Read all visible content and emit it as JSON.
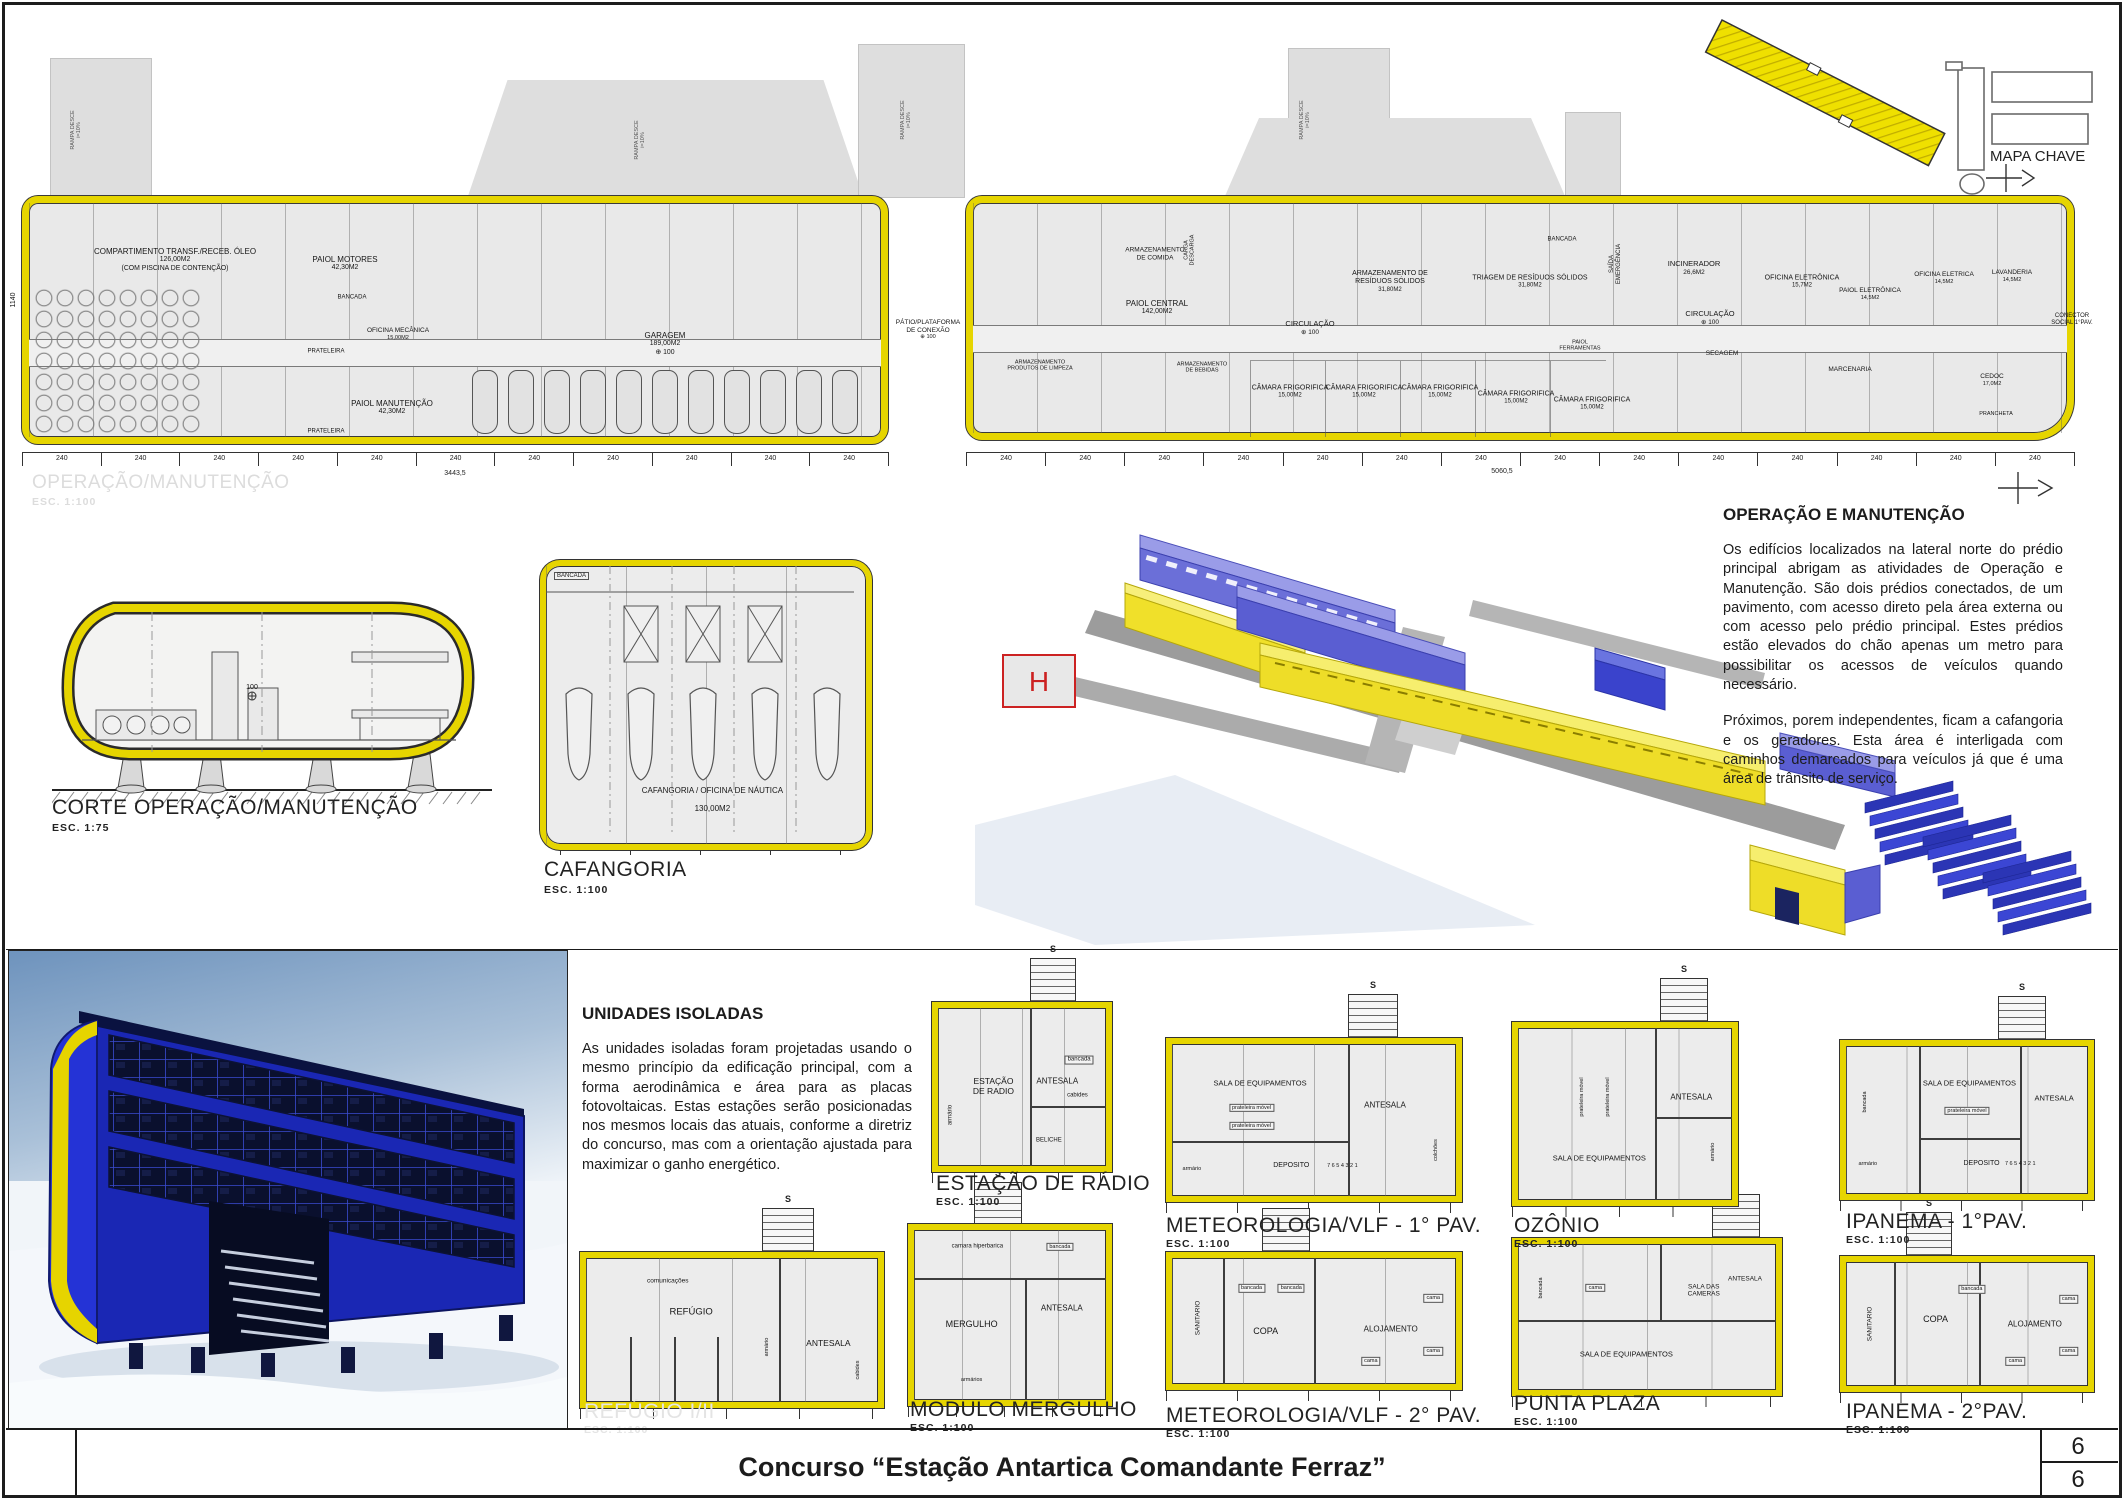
{
  "sheet": {
    "title": "Concurso “Estação Antartica Comandante Ferraz”",
    "page_number_top": "6",
    "page_number_bottom": "6"
  },
  "key_map": {
    "label": "MAPA CHAVE"
  },
  "main_plan": {
    "watermark_title": "OPERAÇÃO/MANUTENÇÃO",
    "watermark_scale": "ESC.  1:100",
    "dim_unit": "240",
    "dim_total_left": "3443,5",
    "dim_total_right": "5060,5",
    "dim_height": "1140",
    "ramp_label": "RAMPA DESCE\ni=10%",
    "ramps": [
      {
        "x": 76,
        "y": 130
      },
      {
        "x": 640,
        "y": 140
      },
      {
        "x": 906,
        "y": 120
      },
      {
        "x": 1305,
        "y": 120
      }
    ],
    "rooms": [
      {
        "label": "COMPARTIMENTO TRANSF./RECEB. ÓLEO",
        "sub": "126,00M2\n(COM PISCINA DE CONTENÇÃO)",
        "x": 175,
        "y": 260,
        "s": 8
      },
      {
        "label": "PAIOL MOTORES",
        "sub": "42,30M2",
        "x": 345,
        "y": 264,
        "s": 8
      },
      {
        "label": "BANCADA",
        "x": 352,
        "y": 298,
        "s": 6
      },
      {
        "label": "OFICINA MECÂNICA",
        "sub": "15,00M2",
        "x": 398,
        "y": 334,
        "s": 6.5
      },
      {
        "label": "PRATELEIRA",
        "x": 326,
        "y": 352,
        "s": 6
      },
      {
        "label": "PAIOL MANUTENÇÃO",
        "sub": "42,30M2",
        "x": 392,
        "y": 408,
        "s": 8
      },
      {
        "label": "PRATELEIRA",
        "x": 326,
        "y": 432,
        "s": 6
      },
      {
        "label": "GARAGEM",
        "sub": "189,00M2\n⊕ 100",
        "x": 665,
        "y": 344,
        "s": 8
      },
      {
        "label": "PÁTIO/PLATAFORMA\nDE CONEXÃO",
        "sub": "⊕ 100",
        "x": 928,
        "y": 330,
        "s": 6.5
      },
      {
        "label": "ARMAZENAMENTO\nDE COMIDA",
        "x": 1155,
        "y": 254,
        "s": 6.5
      },
      {
        "label": "CARGA\nDESCARGA",
        "x": 1190,
        "y": 250,
        "s": 5.5,
        "r": -90
      },
      {
        "label": "PAIOL CENTRAL",
        "sub": "142,00M2",
        "x": 1157,
        "y": 308,
        "s": 8
      },
      {
        "label": "ARMAZENAMENTO DE\nRESÍDUOS SÓLIDOS",
        "sub": "31,80M2",
        "x": 1390,
        "y": 282,
        "s": 7
      },
      {
        "label": "TRIAGEM DE RESÍDUOS SÓLIDOS",
        "sub": "31,80M2",
        "x": 1530,
        "y": 282,
        "s": 7
      },
      {
        "label": "BANCADA",
        "x": 1562,
        "y": 240,
        "s": 6
      },
      {
        "label": "CIRCULAÇÃO",
        "sub": "⊕ 100",
        "x": 1310,
        "y": 328,
        "s": 7.5
      },
      {
        "label": "SAÍDA\nEMERGÊNCIA",
        "x": 1616,
        "y": 264,
        "s": 6,
        "r": -90
      },
      {
        "label": "ARMAZENAMENTO\nPRODUTOS DE LIMPEZA",
        "x": 1040,
        "y": 366,
        "s": 5.5
      },
      {
        "label": "ARMAZENAMENTO\nDE BEBIDAS",
        "x": 1202,
        "y": 368,
        "s": 5.5
      },
      {
        "label": "CÂMARA FRIGORIFICA",
        "sub": "15,00M2",
        "x": 1290,
        "y": 392,
        "s": 7
      },
      {
        "label": "CÂMARA FRIGORIFICA",
        "sub": "15,00M2",
        "x": 1364,
        "y": 392,
        "s": 7
      },
      {
        "label": "CÂMARA FRIGORIFICA",
        "sub": "15,00M2",
        "x": 1440,
        "y": 392,
        "s": 7
      },
      {
        "label": "CÂMARA FRIGORIFICA",
        "sub": "15,00M2",
        "x": 1516,
        "y": 398,
        "s": 7
      },
      {
        "label": "CÂMARA FRIGORIFICA",
        "sub": "15,00M2",
        "x": 1592,
        "y": 404,
        "s": 7
      },
      {
        "label": "PAIOL\nFERRAMENTAS",
        "x": 1580,
        "y": 346,
        "s": 5.5
      },
      {
        "label": "INCINERADOR",
        "sub": "26,6M2",
        "x": 1694,
        "y": 268,
        "s": 7.5
      },
      {
        "label": "OFICINA ELETRÔNICA",
        "sub": "15,7M2",
        "x": 1802,
        "y": 282,
        "s": 7
      },
      {
        "label": "PAIOL ELETRÔNICA",
        "sub": "14,5M2",
        "x": 1870,
        "y": 294,
        "s": 6.5
      },
      {
        "label": "OFICINA ELETRICA",
        "sub": "14,5M2",
        "x": 1944,
        "y": 278,
        "s": 6.5
      },
      {
        "label": "LAVANDERIA",
        "sub": "14,5M2",
        "x": 2012,
        "y": 276,
        "s": 6.5
      },
      {
        "label": "CIRCULAÇÃO",
        "sub": "⊕ 100",
        "x": 1710,
        "y": 318,
        "s": 7.5
      },
      {
        "label": "SECAGEM",
        "x": 1722,
        "y": 354,
        "s": 6.5
      },
      {
        "label": "MARCENARIA",
        "x": 1850,
        "y": 370,
        "s": 6.5
      },
      {
        "label": "CEDOC",
        "sub": "17,0M2",
        "x": 1992,
        "y": 380,
        "s": 6.5
      },
      {
        "label": "PRANCHETA",
        "x": 1996,
        "y": 414,
        "s": 5.5
      },
      {
        "label": "CONECTOR\nSOCIAL 1°PAV.",
        "x": 2072,
        "y": 320,
        "s": 6
      }
    ]
  },
  "section": {
    "title": "CORTE OPERAÇÃO/MANUTENÇÃO",
    "scale": "ESC.  1:75",
    "level": "100"
  },
  "cafangoria": {
    "title": "CAFANGORIA",
    "scale": "ESC.  1:100",
    "room_label": "CAFANGORIA / OFICINA DE NÁUTICA",
    "room_area": "130,00M2",
    "bench_label": "BANCADA"
  },
  "iso": {
    "helipad_label": "H"
  },
  "text_blocks": {
    "operacao": {
      "title": "OPERAÇÃO E MANUTENÇÃO",
      "p1": "Os edifícios localizados na lateral norte do prédio principal abrigam as atividades de Operação e Manutenção. São dois prédios conectados, de um pavimento, com acesso direto pela área externa ou com acesso pelo prédio principal. Estes prédios estão elevados do chão apenas um metro para possibilitar os acessos de veículos quando necessário.",
      "p2": "Próximos, porem independentes, ficam a cafangoria e os geradores. Esta área é interligada com caminhos demarcados para veículos já que é uma área de trânsito de serviço."
    },
    "unidades": {
      "title": "UNIDADES ISOLADAS",
      "p1": "As unidades isoladas foram projetadas usando o mesmo princípio da edificação principal, com a forma aerodinâmica e área para as placas fotovoltaicas. Estas estações serão posicionadas nos mesmos locais das atuais, conforme a diretriz do concurso, mas com a orientação ajustada para maximizar o ganho energético."
    }
  },
  "unit_plans": [
    {
      "id": "estacao-radio",
      "title": "ESTAÇÃO DE RÁDIO",
      "scale": "ESC.  1:100",
      "frame": {
        "x": 932,
        "y": 1002,
        "w": 168,
        "h": 158
      },
      "stair": {
        "x": 1030,
        "y": 958,
        "w": 44,
        "h": 46
      },
      "stair_label": "S",
      "title_pos": {
        "x": 936,
        "y": 1172
      },
      "parts": [
        {
          "o": "v",
          "p": 55,
          "a": 0,
          "b": 100
        },
        {
          "o": "h",
          "p": 62,
          "a": 55,
          "b": 100
        }
      ],
      "labels": [
        {
          "t": "ESTAÇÃO\nDE RADIO",
          "x": 33,
          "y": 50,
          "s": 8.5
        },
        {
          "t": "ANTESALA",
          "x": 71,
          "y": 46,
          "s": 8
        },
        {
          "t": "bancada",
          "x": 84,
          "y": 33,
          "s": 6,
          "bx": true
        },
        {
          "t": "cabides",
          "x": 83,
          "y": 56,
          "s": 6
        },
        {
          "t": "BELICHE",
          "x": 66,
          "y": 84,
          "s": 6
        },
        {
          "t": "armário",
          "x": 8,
          "y": 68,
          "s": 6,
          "r": -90
        }
      ]
    },
    {
      "id": "meteorologia-vlf-1",
      "title": "METEOROLOGIA/VLF - 1° PAV.",
      "scale": "ESC.  1:100",
      "frame": {
        "x": 1166,
        "y": 1038,
        "w": 284,
        "h": 152
      },
      "stair": {
        "x": 1348,
        "y": 994,
        "w": 48,
        "h": 46
      },
      "stair_label": "S",
      "title_pos": {
        "x": 1166,
        "y": 1214
      },
      "parts": [
        {
          "o": "v",
          "p": 62,
          "a": 0,
          "b": 100
        },
        {
          "o": "h",
          "p": 64,
          "a": 0,
          "b": 62
        }
      ],
      "labels": [
        {
          "t": "SALA DE EQUIPAMENTOS",
          "x": 31,
          "y": 26,
          "s": 7.5
        },
        {
          "t": "prateleira móvel",
          "x": 28,
          "y": 42,
          "s": 5.5,
          "bx": true
        },
        {
          "t": "prateleira móvel",
          "x": 28,
          "y": 54,
          "s": 5.5,
          "bx": true
        },
        {
          "t": "ANTESALA",
          "x": 75,
          "y": 40,
          "s": 8
        },
        {
          "t": "armário",
          "x": 7,
          "y": 82,
          "s": 5.5
        },
        {
          "t": "DEPOSITO",
          "x": 42,
          "y": 80,
          "s": 7
        },
        {
          "t": "7 6 5 4 3 2 1",
          "x": 60,
          "y": 80,
          "s": 5.5
        },
        {
          "t": "colchões",
          "x": 93,
          "y": 70,
          "s": 5.5,
          "r": -90
        }
      ]
    },
    {
      "id": "ozonio",
      "title": "OZÔNIO",
      "scale": "ESC.  1:100",
      "frame": {
        "x": 1512,
        "y": 1022,
        "w": 214,
        "h": 172
      },
      "stair": {
        "x": 1660,
        "y": 978,
        "w": 46,
        "h": 46
      },
      "stair_label": "S",
      "title_pos": {
        "x": 1514,
        "y": 1214
      },
      "parts": [
        {
          "o": "v",
          "p": 64,
          "a": 0,
          "b": 100
        },
        {
          "o": "h",
          "p": 52,
          "a": 64,
          "b": 100
        }
      ],
      "labels": [
        {
          "t": "prateleira móvel",
          "x": 30,
          "y": 40,
          "s": 5.5,
          "r": -90
        },
        {
          "t": "prateleira móvel",
          "x": 42,
          "y": 40,
          "s": 5.5,
          "r": -90
        },
        {
          "t": "ANTESALA",
          "x": 81,
          "y": 40,
          "s": 8
        },
        {
          "t": "SALA  DE  EQUIPAMENTOS",
          "x": 38,
          "y": 76,
          "s": 7.5
        },
        {
          "t": "armário",
          "x": 91,
          "y": 72,
          "s": 5.5,
          "r": -90
        }
      ]
    },
    {
      "id": "ipanema-1",
      "title": "IPANEMA - 1°PAV.",
      "scale": "ESC.  1:100",
      "frame": {
        "x": 1840,
        "y": 1040,
        "w": 242,
        "h": 148
      },
      "stair": {
        "x": 1998,
        "y": 996,
        "w": 46,
        "h": 46
      },
      "stair_label": "S",
      "title_pos": {
        "x": 1846,
        "y": 1210
      },
      "parts": [
        {
          "o": "v",
          "p": 30,
          "a": 0,
          "b": 100
        },
        {
          "o": "v",
          "p": 72,
          "a": 0,
          "b": 100
        },
        {
          "o": "h",
          "p": 62,
          "a": 30,
          "b": 72
        }
      ],
      "labels": [
        {
          "t": "bancada",
          "x": 8,
          "y": 38,
          "s": 5.5,
          "r": -90
        },
        {
          "t": "SALA DE EQUIPAMENTOS",
          "x": 51,
          "y": 26,
          "s": 7.5
        },
        {
          "t": "prateleira móvel",
          "x": 50,
          "y": 44,
          "s": 5.5,
          "bx": true
        },
        {
          "t": "ANTESALA",
          "x": 86,
          "y": 36,
          "s": 7.5
        },
        {
          "t": "DEPOSITO",
          "x": 56,
          "y": 80,
          "s": 7
        },
        {
          "t": "7 6 5 4 3 2 1",
          "x": 72,
          "y": 80,
          "s": 5.5
        },
        {
          "t": "armário",
          "x": 9,
          "y": 80,
          "s": 5.5
        }
      ]
    },
    {
      "id": "refugio",
      "title": "REFÚGIO I/II",
      "scale": "ESC.  1:100",
      "watermark": true,
      "frame": {
        "x": 580,
        "y": 1252,
        "w": 292,
        "h": 144
      },
      "stair": {
        "x": 762,
        "y": 1208,
        "w": 50,
        "h": 46
      },
      "stair_label": "S",
      "title_pos": {
        "x": 584,
        "y": 1400
      },
      "parts": [
        {
          "o": "v",
          "p": 66,
          "a": 0,
          "b": 100
        },
        {
          "o": "v",
          "p": 15,
          "a": 55,
          "b": 100
        },
        {
          "o": "v",
          "p": 30,
          "a": 55,
          "b": 100
        },
        {
          "o": "v",
          "p": 45,
          "a": 55,
          "b": 100
        }
      ],
      "labels": [
        {
          "t": "comunicações",
          "x": 28,
          "y": 16,
          "s": 6.5
        },
        {
          "t": "REFÚGIO",
          "x": 36,
          "y": 38,
          "s": 9.5
        },
        {
          "t": "armário",
          "x": 62,
          "y": 62,
          "s": 5.5,
          "r": -90
        },
        {
          "t": "ANTESALA",
          "x": 83,
          "y": 60,
          "s": 8.5
        },
        {
          "t": "cabides",
          "x": 93,
          "y": 78,
          "s": 5.5,
          "r": -90
        }
      ]
    },
    {
      "id": "modulo-mergulho",
      "title": "MODULO MERGULHO",
      "scale": "ESC.  1:100",
      "frame": {
        "x": 908,
        "y": 1224,
        "w": 192,
        "h": 170
      },
      "stair": {
        "x": 974,
        "y": 1182,
        "w": 46,
        "h": 44
      },
      "stair_label": "S",
      "title_pos": {
        "x": 910,
        "y": 1398
      },
      "parts": [
        {
          "o": "h",
          "p": 28,
          "a": 0,
          "b": 100
        },
        {
          "o": "v",
          "p": 58,
          "a": 28,
          "b": 100
        }
      ],
      "labels": [
        {
          "t": "camara hiperbarica",
          "x": 33,
          "y": 10,
          "s": 6
        },
        {
          "t": "bancada",
          "x": 76,
          "y": 10,
          "s": 5.5,
          "bx": true
        },
        {
          "t": "MERGULHO",
          "x": 30,
          "y": 55,
          "s": 9
        },
        {
          "t": "ANTESALA",
          "x": 77,
          "y": 46,
          "s": 8
        },
        {
          "t": "armários",
          "x": 30,
          "y": 88,
          "s": 5.5
        }
      ]
    },
    {
      "id": "meteorologia-vlf-2",
      "title": "METEOROLOGIA/VLF - 2° PAV.",
      "scale": "ESC.  1:100",
      "frame": {
        "x": 1166,
        "y": 1252,
        "w": 284,
        "h": 126
      },
      "stair": {
        "x": 1262,
        "y": 1208,
        "w": 46,
        "h": 44
      },
      "stair_label": "S",
      "title_pos": {
        "x": 1166,
        "y": 1404
      },
      "parts": [
        {
          "o": "v",
          "p": 18,
          "a": 0,
          "b": 100
        },
        {
          "o": "v",
          "p": 50,
          "a": 0,
          "b": 100
        }
      ],
      "labels": [
        {
          "t": "SANITARIO",
          "x": 9,
          "y": 48,
          "s": 6.5,
          "r": -90
        },
        {
          "t": "COPA",
          "x": 33,
          "y": 58,
          "s": 9
        },
        {
          "t": "bancada",
          "x": 28,
          "y": 24,
          "s": 5.5,
          "bx": true
        },
        {
          "t": "bancada",
          "x": 42,
          "y": 24,
          "s": 5.5,
          "bx": true
        },
        {
          "t": "ALOJAMENTO",
          "x": 77,
          "y": 56,
          "s": 8
        },
        {
          "t": "cama",
          "x": 92,
          "y": 32,
          "s": 5.5,
          "bx": true
        },
        {
          "t": "cama",
          "x": 92,
          "y": 74,
          "s": 5.5,
          "bx": true
        },
        {
          "t": "cama",
          "x": 70,
          "y": 82,
          "s": 5.5,
          "bx": true
        }
      ]
    },
    {
      "id": "punta-plaza",
      "title": "PUNTA PLAZA",
      "scale": "ESC.  1:100",
      "frame": {
        "x": 1512,
        "y": 1238,
        "w": 258,
        "h": 146
      },
      "stair": {
        "x": 1712,
        "y": 1194,
        "w": 46,
        "h": 44
      },
      "stair_label": "S",
      "title_pos": {
        "x": 1514,
        "y": 1392
      },
      "parts": [
        {
          "o": "h",
          "p": 52,
          "a": 0,
          "b": 100
        },
        {
          "o": "v",
          "p": 55,
          "a": 0,
          "b": 52
        }
      ],
      "labels": [
        {
          "t": "bancada",
          "x": 9,
          "y": 30,
          "s": 5.5,
          "r": -90
        },
        {
          "t": "SALA DAS\nCAMERAS",
          "x": 72,
          "y": 32,
          "s": 6.5
        },
        {
          "t": "ANTESALA",
          "x": 88,
          "y": 24,
          "s": 6.5
        },
        {
          "t": "SALA  DE  EQUIPAMENTOS",
          "x": 42,
          "y": 76,
          "s": 7.5
        },
        {
          "t": "cama",
          "x": 30,
          "y": 30,
          "s": 5.5,
          "bx": true
        }
      ]
    },
    {
      "id": "ipanema-2",
      "title": "IPANEMA - 2°PAV.",
      "scale": "ESC.  1:100",
      "frame": {
        "x": 1840,
        "y": 1256,
        "w": 242,
        "h": 124
      },
      "stair": {
        "x": 1906,
        "y": 1212,
        "w": 44,
        "h": 44
      },
      "stair_label": "S",
      "title_pos": {
        "x": 1846,
        "y": 1400
      },
      "parts": [
        {
          "o": "v",
          "p": 20,
          "a": 0,
          "b": 100
        },
        {
          "o": "v",
          "p": 55,
          "a": 0,
          "b": 100
        }
      ],
      "labels": [
        {
          "t": "SANITARIO",
          "x": 10,
          "y": 50,
          "s": 6.5,
          "r": -90
        },
        {
          "t": "COPA",
          "x": 37,
          "y": 46,
          "s": 9
        },
        {
          "t": "bancada",
          "x": 52,
          "y": 22,
          "s": 5.5,
          "bx": true
        },
        {
          "t": "ALOJAMENTO",
          "x": 78,
          "y": 50,
          "s": 8
        },
        {
          "t": "cama",
          "x": 92,
          "y": 30,
          "s": 5.5,
          "bx": true
        },
        {
          "t": "cama",
          "x": 92,
          "y": 72,
          "s": 5.5,
          "bx": true
        },
        {
          "t": "cama",
          "x": 70,
          "y": 80,
          "s": 5.5,
          "bx": true
        }
      ]
    }
  ]
}
